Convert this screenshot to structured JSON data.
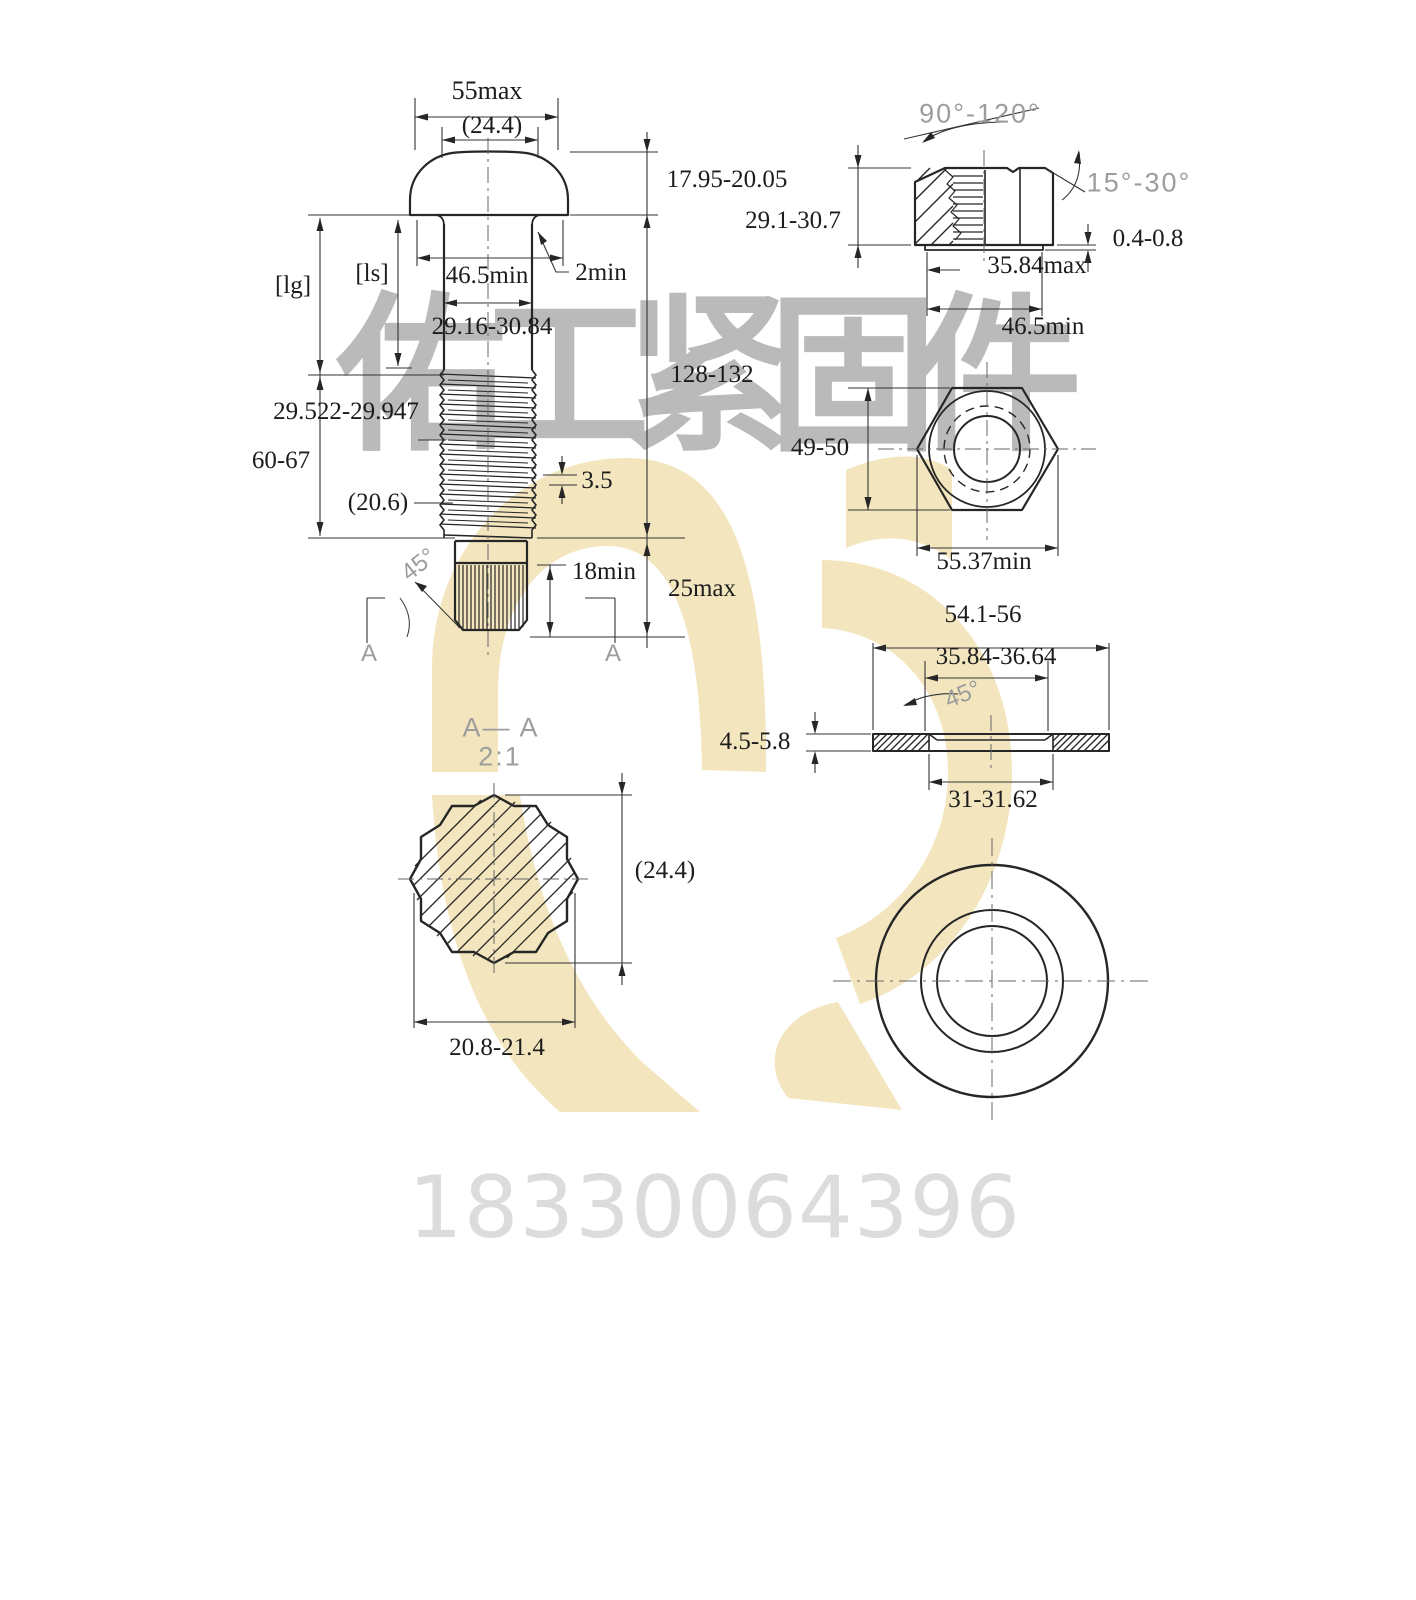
{
  "colors": {
    "line": "#262626",
    "annotation_gray": "#9d9d9d",
    "watermark_gray": "#bababa",
    "phone_gray": "#dcdcdc",
    "logo_yellow": "#f3e6bf"
  },
  "bolt": {
    "head_dia": "55max",
    "head_ref": "(24.4)",
    "head_height": "17.95-20.05",
    "bearing_dia": "46.5min",
    "fillet": "2min",
    "shank_dia": "29.16-30.84",
    "grip_len": "[lg]",
    "shank_len": "[ls]",
    "thread_dia": "29.522-29.947",
    "thread_len": "60-67",
    "runout_ref": "(20.6)",
    "pitch": "3.5",
    "total_len": "128-132",
    "spline_len": "18min",
    "end_len": "25max",
    "chamfer_angle": "45°",
    "section_mark_left": "A",
    "section_mark_right": "A"
  },
  "nut": {
    "countersink_angle": "90°-120°",
    "face_angle": "15°-30°",
    "height": "29.1-30.7",
    "washer_face_height": "0.4-0.8",
    "washer_face_dia": "35.84max",
    "bearing_dia": "46.5min",
    "across_flats": "49-50",
    "across_corners": "55.37min"
  },
  "section": {
    "title": "A— A",
    "scale": "2:1",
    "dia_ref": "(24.4)",
    "spline_width": "20.8-21.4"
  },
  "washer": {
    "outer_dia": "54.1-56",
    "chamfer_dia": "35.84-36.64",
    "chamfer_angle": "45°",
    "thickness": "4.5-5.8",
    "inner_dia": "31-31.62"
  },
  "watermark": {
    "company": "佑工紧固件",
    "phone": "18330064396"
  }
}
